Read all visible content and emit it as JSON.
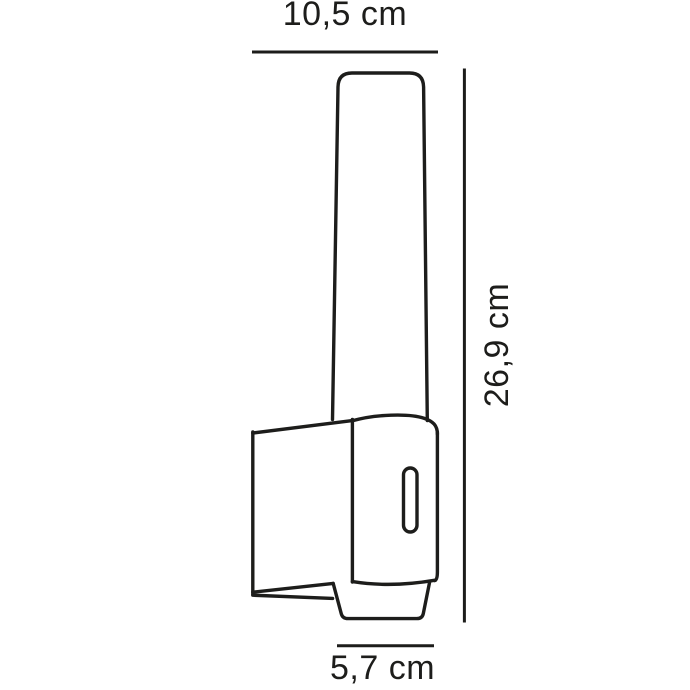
{
  "page": {
    "background_color": "#ffffff",
    "line_color": "#1d1d1b",
    "text_color": "#1d1d1b"
  },
  "diagram": {
    "kind": "product-dimension-line-drawing",
    "subject": "wall lamp with tapered tubular shade, wall bracket with slot, and base cup",
    "labels": {
      "width": "10,5 cm",
      "height": "26,9 cm",
      "depth": "5,7 cm"
    },
    "measurements": [
      {
        "name": "overall-width",
        "label": "10,5 cm",
        "value_cm": 10.5,
        "position": "top"
      },
      {
        "name": "overall-height",
        "label": "26,9 cm",
        "value_cm": 26.9,
        "position": "right"
      },
      {
        "name": "base-width",
        "label": "5,7 cm",
        "value_cm": 5.7,
        "position": "bottom"
      }
    ]
  }
}
